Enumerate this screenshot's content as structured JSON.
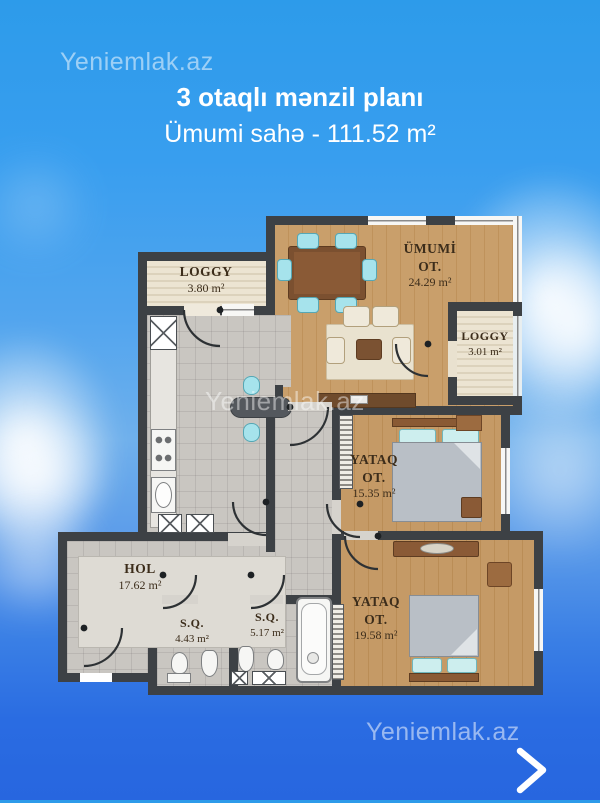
{
  "watermarks": {
    "top": "Yeniemlak.az",
    "middle": "Yeniemlak.az",
    "bottom": "Yeniemlak.az"
  },
  "header": {
    "title": "3 otaqlı mənzil planı",
    "subtitle": "Ümumi sahə - 111.52 m²"
  },
  "rooms": [
    {
      "id": "loggia-top",
      "name": "LOGGY",
      "area": "3.80 m²"
    },
    {
      "id": "living-room",
      "name": "ÜMUMİ",
      "name2": "OT.",
      "area": "24.29 m²"
    },
    {
      "id": "loggia-right",
      "name": "LOGGY",
      "area": "3.01 m²"
    },
    {
      "id": "bedroom-1",
      "name": "YATAQ",
      "name2": "OT.",
      "area": "15.35 m²"
    },
    {
      "id": "hall",
      "name": "HOL",
      "area": "17.62 m²"
    },
    {
      "id": "bathroom-1",
      "name": "S.Q.",
      "area": "4.43 m²"
    },
    {
      "id": "bathroom-2",
      "name": "S.Q.",
      "area": "5.17 m²"
    },
    {
      "id": "bedroom-2",
      "name": "YATAQ",
      "name2": "OT.",
      "area": "19.58 m²"
    }
  ],
  "nav": {
    "next_icon": "chevron-right"
  },
  "colors": {
    "sky_top": "#2d9bea",
    "sky_bottom": "#2766df",
    "wall": "#3d4145",
    "wood_floor": "#c79e6d",
    "tile_floor": "#c9c6c1",
    "loggia_floor": "#e9e1cf",
    "furniture_wood": "#8a5a36",
    "accent_teal": "#a6e3ec",
    "text_light": "#ffffff",
    "label_dark": "#3c2d1b"
  }
}
